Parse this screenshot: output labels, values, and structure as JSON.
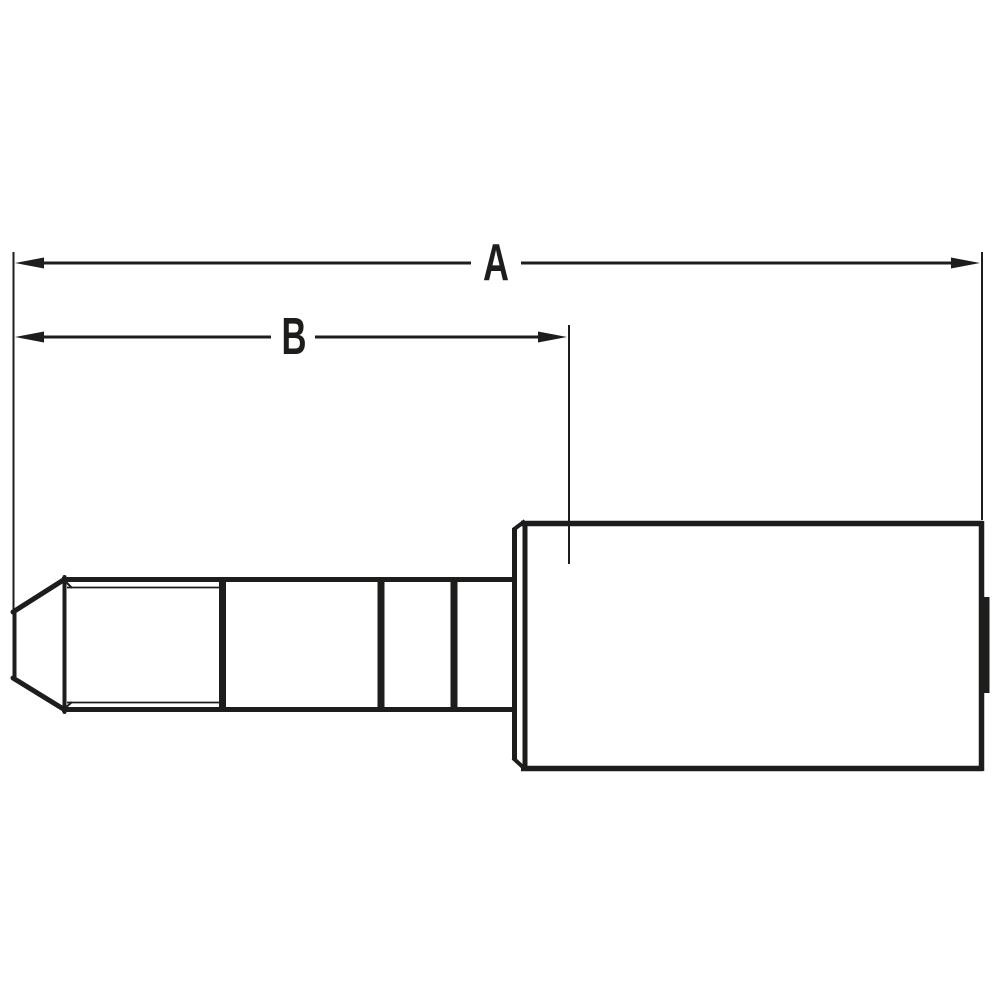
{
  "drawing": {
    "background": "#ffffff",
    "line_color": "#1d1d1b",
    "dimensions": {
      "a": {
        "label": "A"
      },
      "b": {
        "label": "B"
      }
    }
  }
}
